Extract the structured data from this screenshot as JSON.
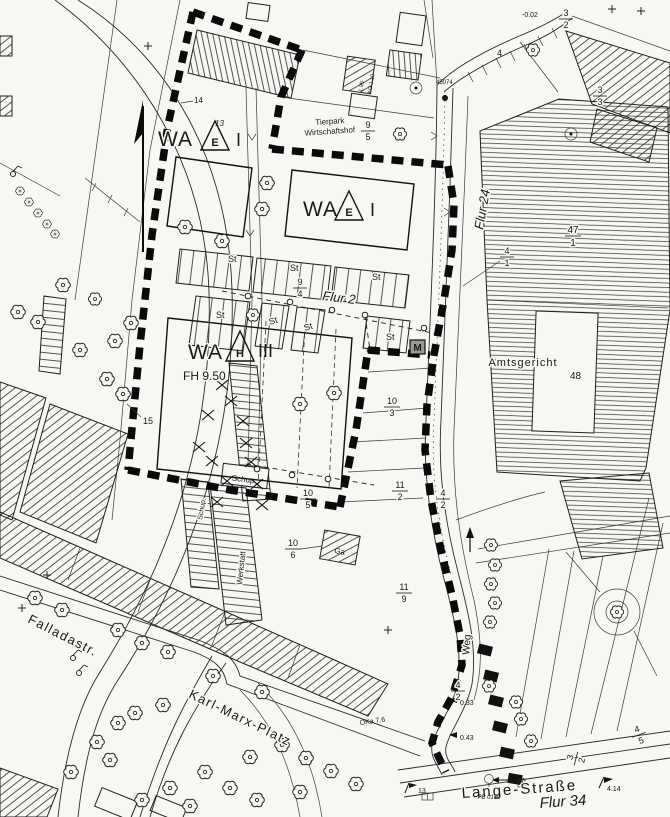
{
  "zones": {
    "wa1": {
      "prefix": "WA",
      "symbol": "E",
      "suffix": "I"
    },
    "wa2": {
      "prefix": "WA",
      "symbol": "E",
      "suffix": "I"
    },
    "wa3": {
      "prefix": "WA",
      "symbol": "H",
      "suffix": "III",
      "height": "FH 9.50"
    }
  },
  "streets": {
    "fallada": "Falladastr.",
    "karl_marx": "Karl-Marx-Platz",
    "lange": "Lange-Straße",
    "weg": "Weg"
  },
  "districts": {
    "flur2": "Flur 2",
    "flur24": "Flur 24",
    "flur34": "Flur 34"
  },
  "buildings": {
    "amtsgericht": "Amtsgericht",
    "amtsgericht_no": "48",
    "tierpark_line1": "Tierpark",
    "tierpark_line2": "Wirtschaftshof",
    "werkstatt": "Werkstatt",
    "schup": "Schup.",
    "schup2": "Schup.",
    "garage": "Ga",
    "station": "M"
  },
  "parking": {
    "stall": "St"
  },
  "parcel_numbers": {
    "n13": "13",
    "n14": "14",
    "n15": "15",
    "n4": "4"
  },
  "fractions": {
    "f9_5": {
      "num": "9",
      "den": "5"
    },
    "f9_4": {
      "num": "9",
      "den": "4"
    },
    "f10_3": {
      "num": "10",
      "den": "3"
    },
    "f11_2": {
      "num": "11",
      "den": "2"
    },
    "f4_2": {
      "num": "4",
      "den": "2"
    },
    "f10_5": {
      "num": "10",
      "den": "5"
    },
    "f10_6": {
      "num": "10",
      "den": "6"
    },
    "f11_9": {
      "num": "11",
      "den": "9"
    },
    "f47_1": {
      "num": "47",
      "den": "1"
    },
    "f4_1": {
      "num": "4",
      "den": "1"
    },
    "f3_3": {
      "num": "3",
      "den": "3"
    },
    "f3_2": {
      "num": "3",
      "den": "2"
    },
    "f4_5": {
      "num": "4",
      "den": "5"
    }
  },
  "annotations": {
    "neg002": "-0.02",
    "pt45074": "45074",
    "oka": "OKa 7.6",
    "v033": "0.33",
    "v043": "0.43",
    "v097": "0.97",
    "v414": "4.14",
    "v195": "1.95",
    "kg110": "KG 1.10",
    "pb0150": "PB 0150",
    "pt13": "13"
  }
}
